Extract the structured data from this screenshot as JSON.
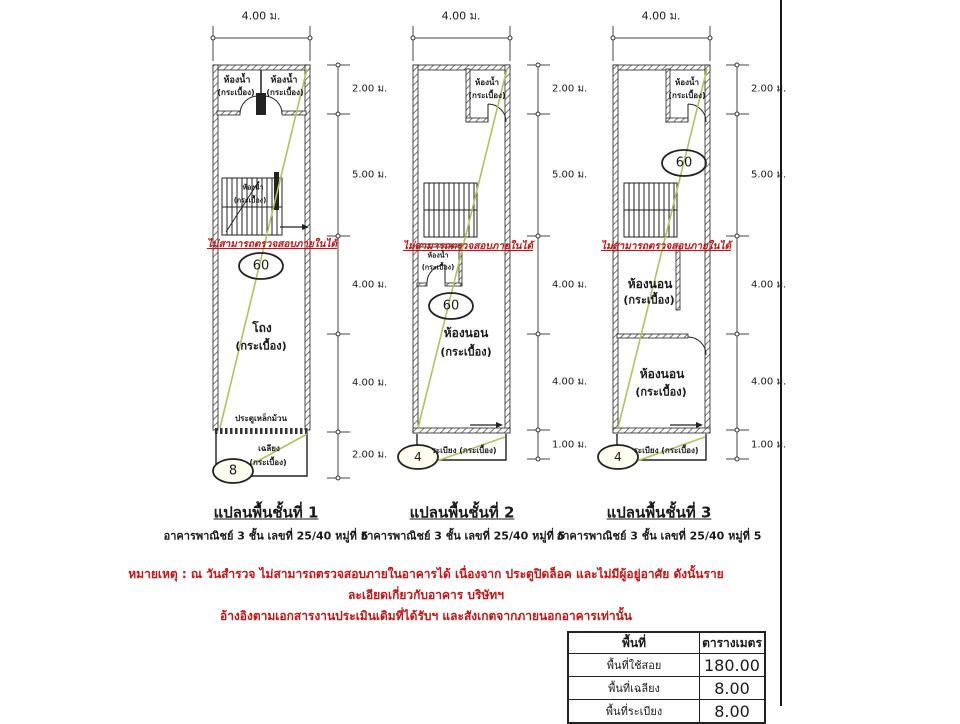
{
  "dims": {
    "top": "4.00 ม.",
    "plan1": [
      "2.00 ม.",
      "5.00 ม.",
      "4.00 ม.",
      "4.00 ม.",
      "2.00 ม."
    ],
    "plan2": [
      "2.00 ม.",
      "5.00 ม.",
      "4.00 ม.",
      "4.00 ม.",
      "1.00 ม."
    ],
    "plan3": [
      "2.00 ม.",
      "5.00 ม.",
      "4.00 ม.",
      "4.00 ม.",
      "1.00 ม."
    ]
  },
  "overlays": {
    "no_access": "ไม่สามารถตรวจสอบภายในได้"
  },
  "ovals": {
    "plan1_main": "60",
    "plan1_porch": "8",
    "plan2_main": "60",
    "plan2_balcony": "4",
    "plan3_main": "60",
    "plan3_balcony": "4"
  },
  "labels": {
    "plan1": {
      "bath": "ห้องน้ำ",
      "tiles": "(กระเบื้อง)",
      "hall": "โถง",
      "roller_door": "ประตูเหล็กม้วน",
      "porch": "เฉลียง"
    },
    "plan2": {
      "bath": "ห้องน้ำ",
      "tiles": "(กระเบื้อง)",
      "bedroom": "ห้องนอน",
      "balcony": "ระเบียง (กระเบื้อง)"
    },
    "plan3": {
      "bath": "ห้องน้ำ",
      "tiles": "(กระเบื้อง)",
      "bedroom": "ห้องนอน",
      "balcony": "ระเบียง (กระเบื้อง)"
    }
  },
  "captions": [
    {
      "title": "แปลนพื้นชั้นที่ 1",
      "subtitle": "อาคารพาณิชย์ 3 ชั้น เลขที่ 25/40 หมู่ที่ 5"
    },
    {
      "title": "แปลนพื้นชั้นที่ 2",
      "subtitle": "อาคารพาณิชย์ 3 ชั้น เลขที่ 25/40 หมู่ที่ 5"
    },
    {
      "title": "แปลนพื้นชั้นที่ 3",
      "subtitle": "อาคารพาณิชย์ 3 ชั้น เลขที่ 25/40 หมู่ที่ 5"
    }
  ],
  "note": {
    "line1": "หมายเหตุ : ณ วันสำรวจ ไม่สามารถตรวจสอบภายในอาคารได้ เนื่องจาก ประตูปิดล็อค และไม่มีผู้อยู่อาศัย  ดังนั้นรายละเอียดเกี่ยวกับอาคาร บริษัทฯ",
    "line2": "อ้างอิงตามเอกสารงานประเมินเดิมที่ได้รับฯ และสังเกตจากภายนอกอาคารเท่านั้น"
  },
  "area_table": {
    "headers": [
      "พื้นที่",
      "ตารางเมตร"
    ],
    "rows": [
      {
        "label": "พื้นที่ใช้สอย",
        "value": "180.00"
      },
      {
        "label": "พื้นที่เฉลียง",
        "value": "8.00"
      },
      {
        "label": "พื้นที่ระเบียง",
        "value": "8.00"
      }
    ]
  }
}
